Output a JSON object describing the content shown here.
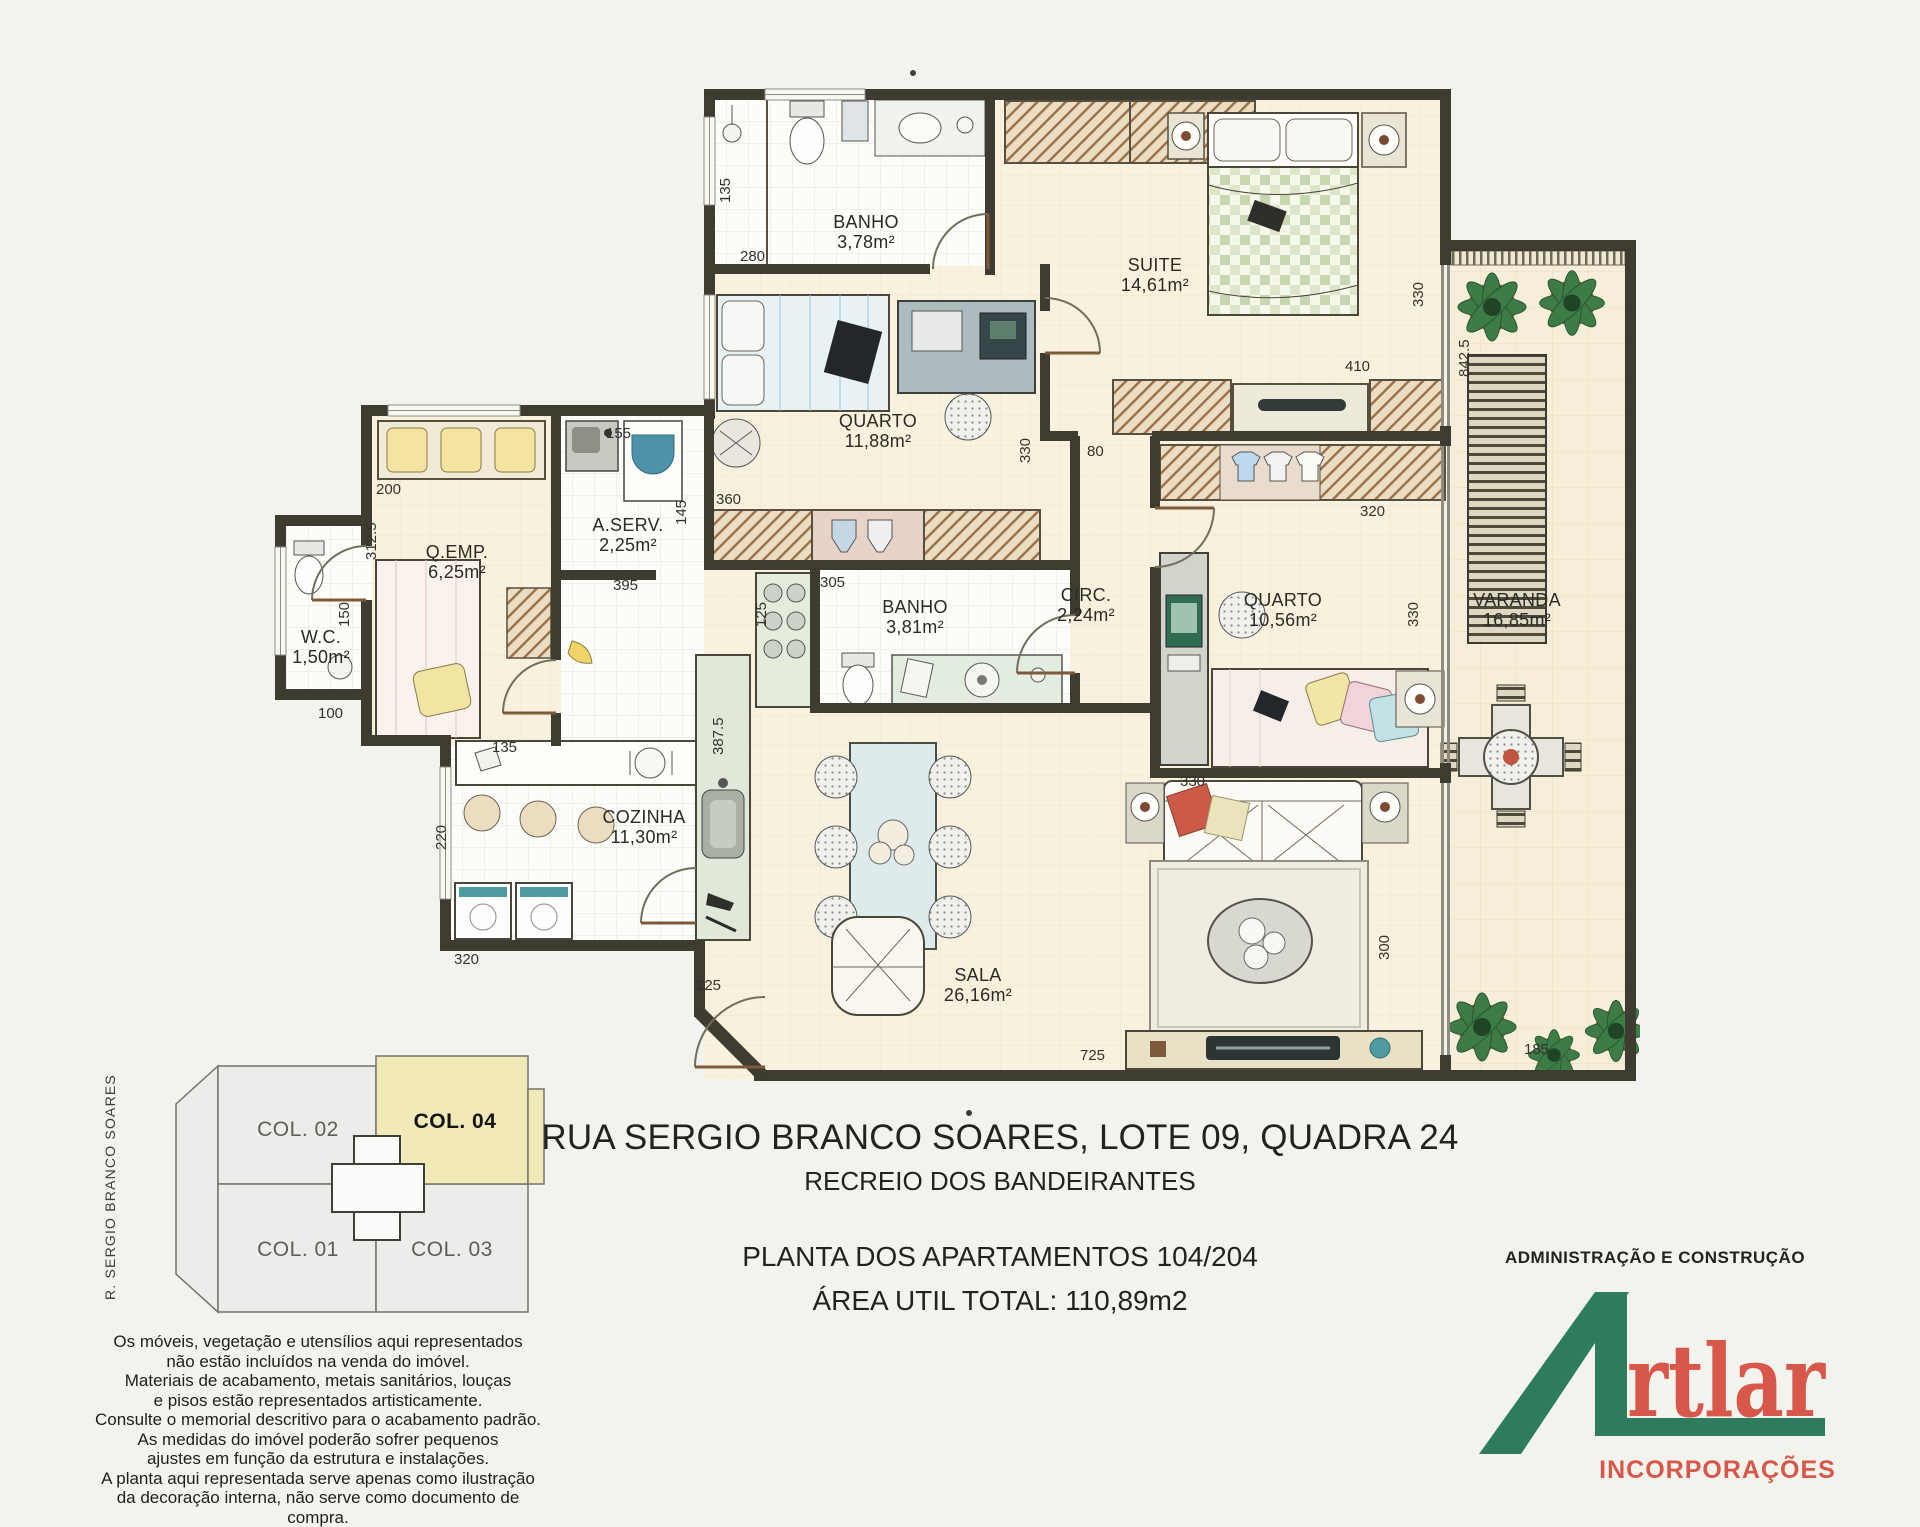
{
  "title_block": {
    "address": "RUA SERGIO BRANCO SOARES, LOTE 09, QUADRA 24",
    "district": "RECREIO DOS BANDEIRANTES",
    "plan_line": "PLANTA  DOS APARTAMENTOS 104/204",
    "area_line": "ÁREA UTIL TOTAL: 110,89m2"
  },
  "branding": {
    "admin_line": "ADMINISTRAÇÃO E CONSTRUÇÃO",
    "logo_prefix": "A",
    "logo_rest": "rtlar",
    "logo_full": "Artlar",
    "logo_sub": "INCORPORAÇÕES",
    "green": "#2e7c5e",
    "red": "#d7584a"
  },
  "key_plan": {
    "street_label": "R. SERGIO BRANCO SOARES",
    "highlight_color": "#f1eab8",
    "units": [
      {
        "label": "COL. 02",
        "highlighted": false
      },
      {
        "label": "COL. 04",
        "highlighted": true
      },
      {
        "label": "COL. 01",
        "highlighted": false
      },
      {
        "label": "COL. 03",
        "highlighted": false
      }
    ]
  },
  "disclaimer": {
    "lines": [
      "Os móveis, vegetação e utensílios aqui representados",
      "não estão incluídos na venda do imóvel.",
      "Materiais de acabamento, metais sanitários, louças",
      "e pisos estão representados artisticamente.",
      "Consulte o memorial descritivo para o acabamento padrão.",
      "As medidas do imóvel  poderão sofrer  pequenos",
      "ajustes em função da estrutura e instalações.",
      "A planta aqui representada serve apenas como  ilustração",
      "da decoração interna, não serve como documento de compra."
    ]
  },
  "floor_plan": {
    "wall_color": "#3e3b31",
    "floor_cream": "#f8f1dd",
    "tile_white": "#fcfcf8",
    "rooms": [
      {
        "name": "BANHO",
        "area": "3,78m²"
      },
      {
        "name": "SUITE",
        "area": "14,61m²"
      },
      {
        "name": "QUARTO",
        "area": "11,88m²"
      },
      {
        "name": "A.SERV.",
        "area": "2,25m²"
      },
      {
        "name": "Q.EMP.",
        "area": "6,25m²"
      },
      {
        "name": "W.C.",
        "area": "1,50m²"
      },
      {
        "name": "BANHO",
        "area": "3,81m²"
      },
      {
        "name": "CIRC.",
        "area": "2,24m²"
      },
      {
        "name": "QUARTO",
        "area": "10,56m²"
      },
      {
        "name": "VARANDA",
        "area": "16,85m²"
      },
      {
        "name": "COZINHA",
        "area": "11,30m²"
      },
      {
        "name": "SALA",
        "area": "26,16m²"
      }
    ],
    "dimensions": [
      "135",
      "280",
      "330",
      "410",
      "80",
      "320",
      "330",
      "842.5",
      "360",
      "330",
      "155",
      "145",
      "200",
      "312.5",
      "150",
      "100",
      "305",
      "125",
      "395",
      "387.5",
      "135",
      "220",
      "320",
      "225",
      "725",
      "330",
      "300",
      "185"
    ]
  }
}
